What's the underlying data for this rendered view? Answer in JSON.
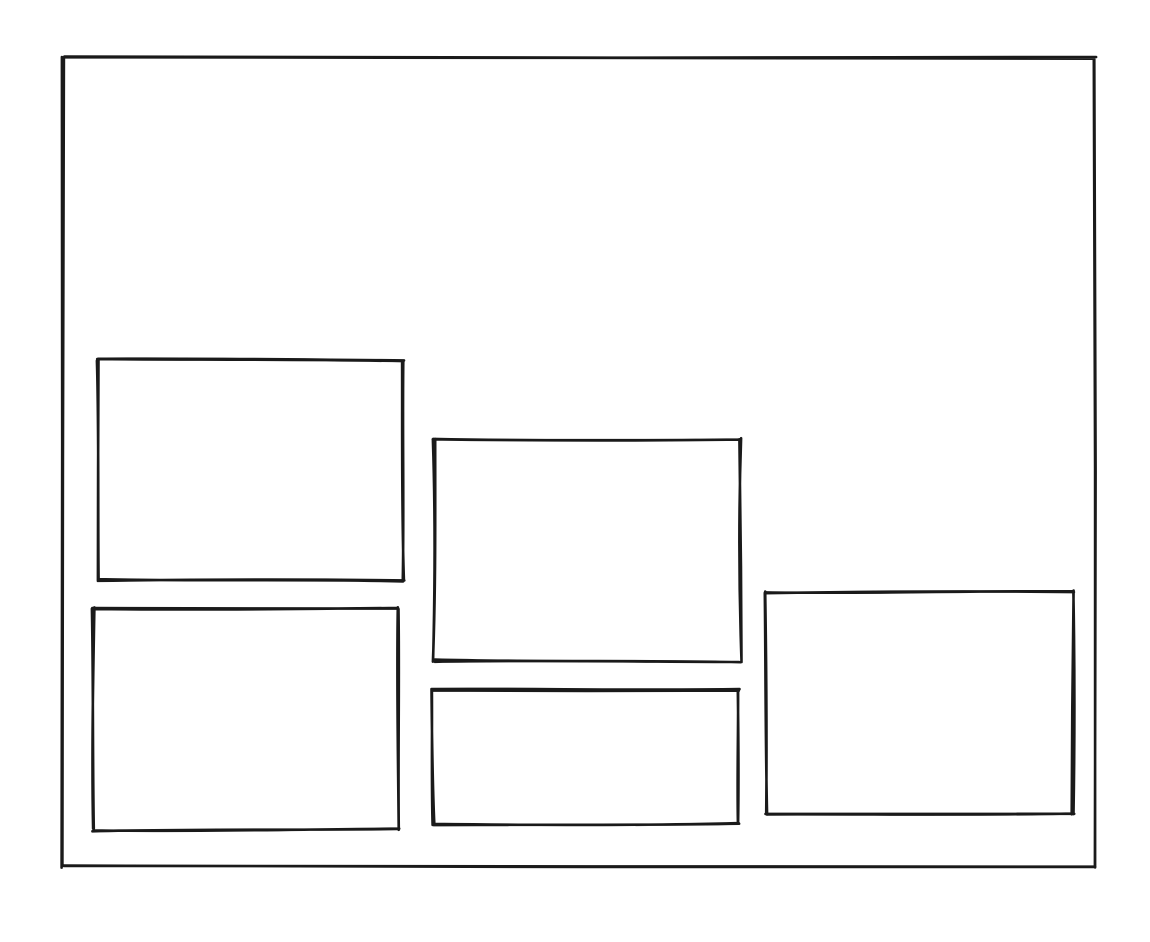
{
  "canvas": {
    "width": 1150,
    "height": 942,
    "background_color": "#ffffff",
    "stroke_color": "#1a1a1a",
    "stroke_width": 2.6
  },
  "sketch": {
    "frame": {
      "id": "outer-frame",
      "x": 63,
      "y": 58,
      "w": 1032,
      "h": 809,
      "seed": 11
    },
    "boxes": [
      {
        "id": "box-top-left",
        "x": 98,
        "y": 360,
        "w": 305,
        "h": 220,
        "seed": 21
      },
      {
        "id": "box-center-tall",
        "x": 434,
        "y": 439,
        "w": 306,
        "h": 222,
        "seed": 35
      },
      {
        "id": "box-bottom-left",
        "x": 93,
        "y": 608,
        "w": 305,
        "h": 222,
        "seed": 47
      },
      {
        "id": "box-center-short",
        "x": 433,
        "y": 690,
        "w": 305,
        "h": 134,
        "seed": 59
      },
      {
        "id": "box-right",
        "x": 766,
        "y": 592,
        "w": 307,
        "h": 222,
        "seed": 73
      }
    ]
  }
}
